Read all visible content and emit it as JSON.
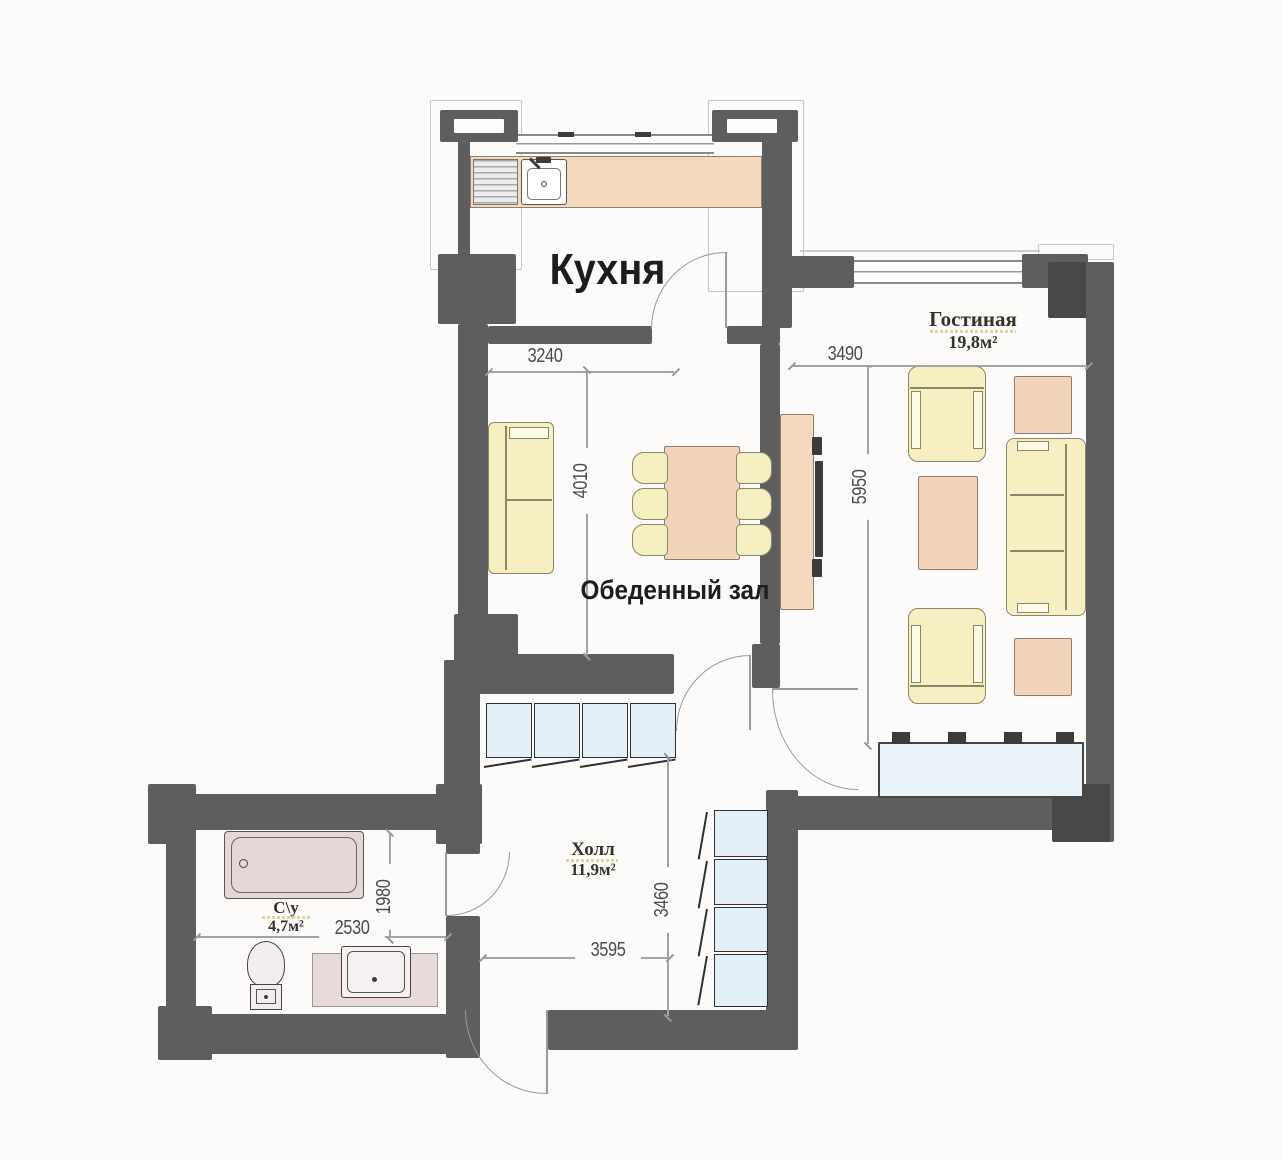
{
  "plan": {
    "title": "apartment-floor-plan",
    "rooms": {
      "kitchen": {
        "name": "Кухня"
      },
      "dining": {
        "name": "Обеденный зал"
      },
      "living": {
        "name": "Гостиная",
        "area": "19,8м²"
      },
      "hall": {
        "name": "Холл",
        "area": "11,9м²"
      },
      "bathroom": {
        "name": "С\\у",
        "area": "4,7м²"
      }
    },
    "dimensions_mm": {
      "kitchen_width": "3240",
      "dining_depth": "4010",
      "living_width": "3490",
      "living_depth": "5950",
      "hall_depth": "3460",
      "hall_width": "3595",
      "bathroom_depth": "1980",
      "bathroom_width": "2530"
    },
    "colors": {
      "wall": "#5e5e5e",
      "pillar": "#484848",
      "counter_peach": "#f4d9bf",
      "furniture_peach": "#f2d4ba",
      "upholstery_yellow": "#f6efc2",
      "wardrobe_blue": "#e3f0f7",
      "window_sill_blue": "#e9f3f8",
      "sanitary_pink": "#e6d7d7",
      "label_underline": "#d6db96"
    }
  }
}
